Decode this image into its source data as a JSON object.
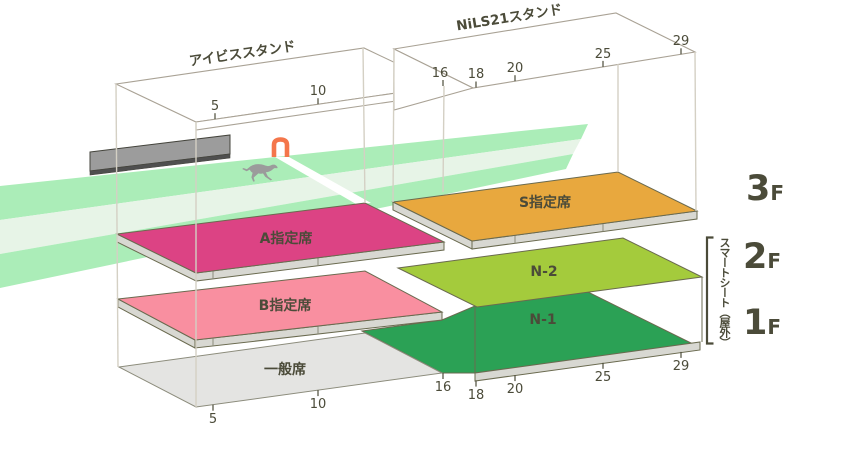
{
  "stands": {
    "ibis": {
      "name": "アイビススタンド",
      "gates": [
        "5",
        "10",
        "16"
      ]
    },
    "nils21": {
      "name": "NiLS21スタンド",
      "gates": [
        "18",
        "20",
        "25",
        "29"
      ]
    }
  },
  "seats": {
    "s": {
      "label": "S指定席",
      "color": "#E8A83E"
    },
    "a": {
      "label": "A指定席",
      "color": "#DC4384"
    },
    "b": {
      "label": "B指定席",
      "color": "#F98FA0"
    },
    "n2": {
      "label": "N-2",
      "color": "#A4CB3C"
    },
    "n1": {
      "label": "N-1",
      "color": "#2BA155"
    },
    "general": {
      "label": "一般席",
      "color": "#E4E4E2"
    }
  },
  "floors": {
    "f3": {
      "num": "3",
      "suffix": "F"
    },
    "f2": {
      "num": "2",
      "suffix": "F"
    },
    "f1": {
      "num": "1",
      "suffix": "F"
    }
  },
  "annotations": {
    "smart_seat": "スマートシート（屋外）"
  },
  "colors": {
    "track_green": "#ABEDB8",
    "track_pale": "#E7F4E7",
    "finish_line": "#FFFFFF",
    "board": "#9C9C9C",
    "board_dark": "#4F4F4F",
    "horse": "#9B9B9B",
    "post": "#F4764B",
    "plate_side": "#D8D8D2",
    "text": "#4B4B39"
  }
}
